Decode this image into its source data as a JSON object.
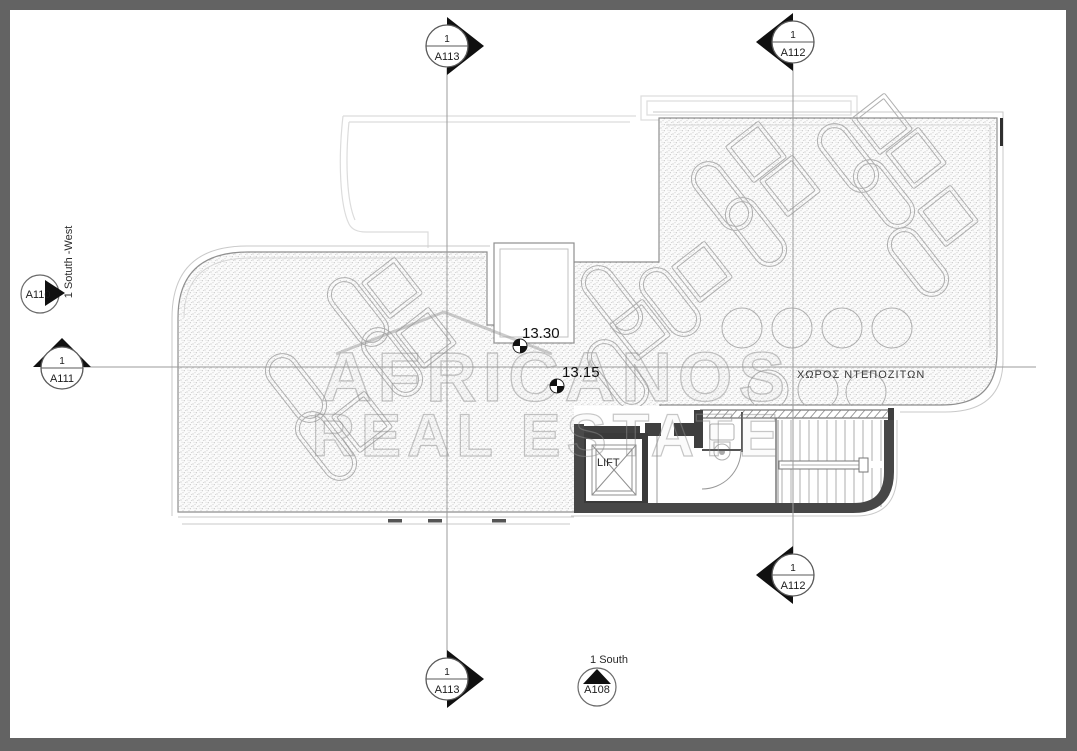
{
  "drawing": {
    "type": "architectural-roof-plan",
    "watermark": {
      "line1": "AFRICANOS",
      "line2": "REAL ESTATE"
    },
    "room_labels": {
      "lift": "LIFT",
      "tank_room": "ΧΩΡΟΣ ΝΤΕΠΟΖΙΤΩΝ"
    },
    "spot_elevations": {
      "upper": "13.30",
      "lower": "13.15"
    },
    "annotations": {
      "south_ref": "1 South",
      "southwest_ref": "1 Sotuth -West"
    }
  },
  "markers": {
    "a113_top": {
      "number": "1",
      "sheet": "A113"
    },
    "a112_top": {
      "number": "1",
      "sheet": "A112"
    },
    "a110": {
      "sheet": "A110"
    },
    "a111": {
      "number": "1",
      "sheet": "A111"
    },
    "a112_bottom": {
      "number": "1",
      "sheet": "A112"
    },
    "a113_bottom": {
      "number": "1",
      "sheet": "A113"
    },
    "a108": {
      "sheet": "A108"
    }
  },
  "colors": {
    "frame": "#636363",
    "paper": "#ffffff",
    "wall_ink": "#474747",
    "line_gray": "#9a9a9a",
    "marker_fill": "#101010"
  }
}
